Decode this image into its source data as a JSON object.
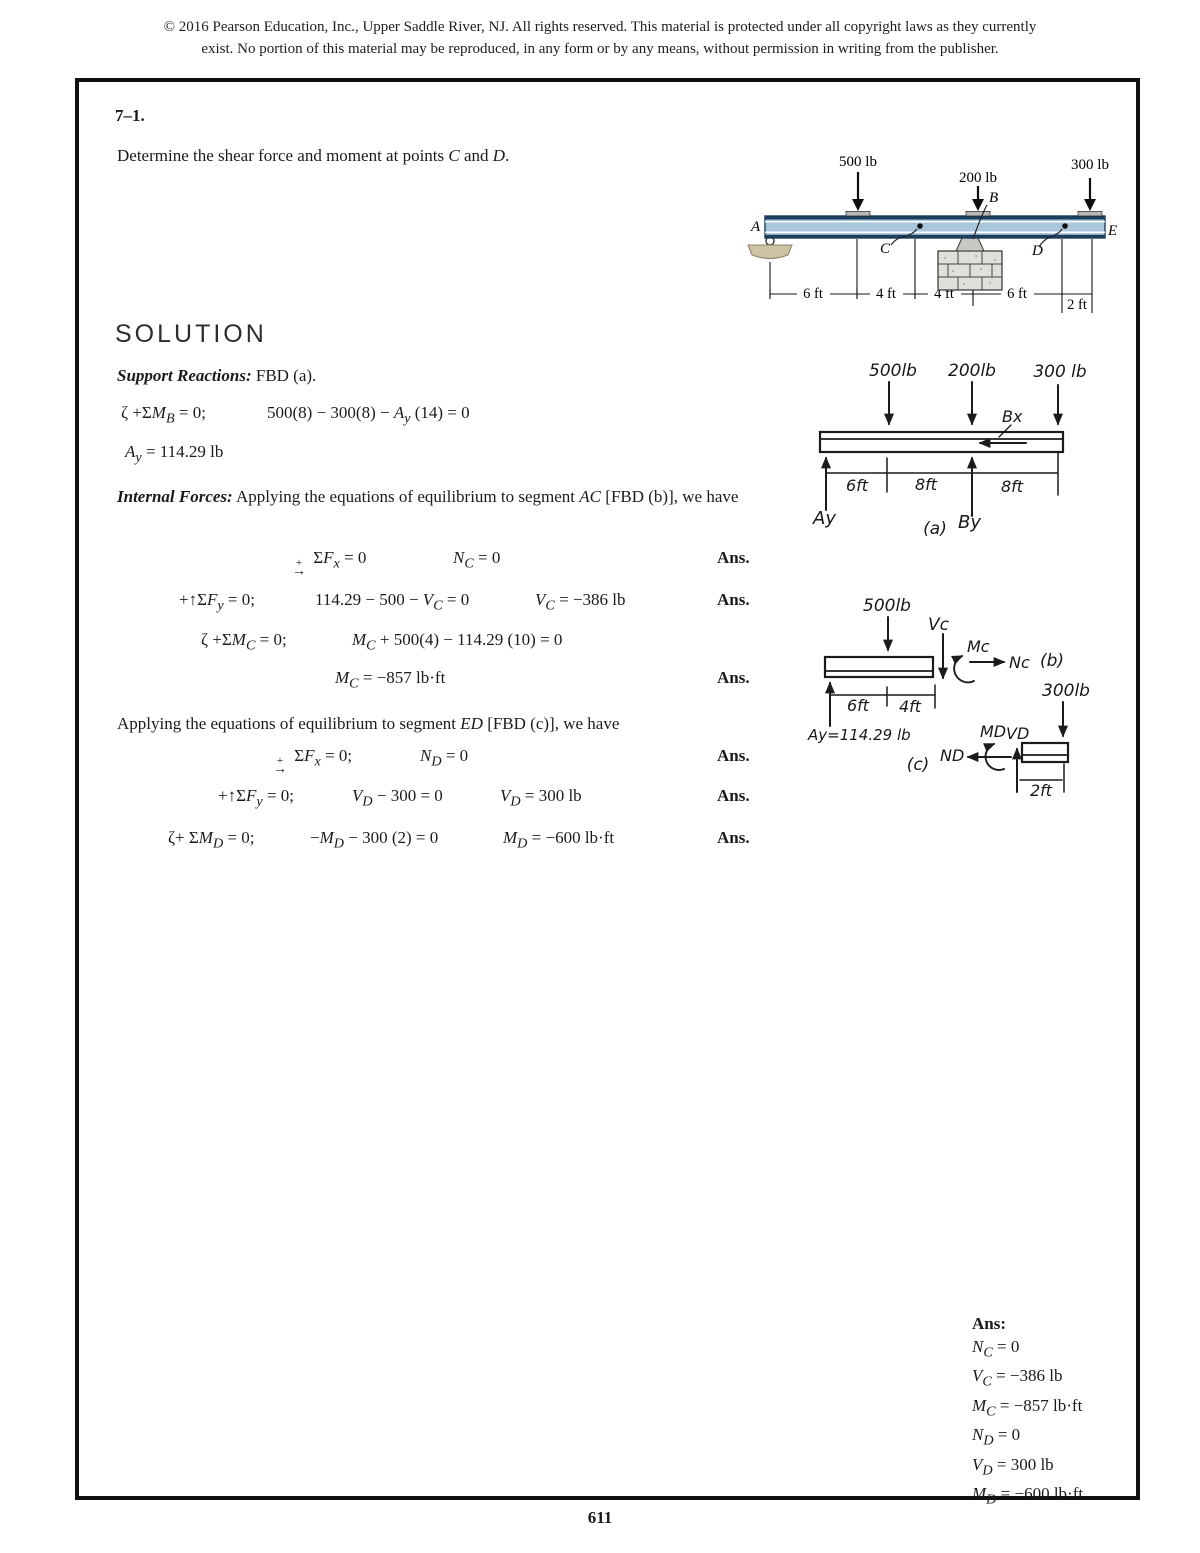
{
  "header": {
    "line1": "© 2016 Pearson Education, Inc., Upper Saddle River, NJ.  All rights reserved. This material is protected under all copyright laws as they currently",
    "line2": "exist. No portion of this material may be reproduced, in any form or by any means, without permission in writing from the publisher."
  },
  "problem": {
    "number": "7–1.",
    "statement": "Determine the shear force and moment at points <i>C</i> and <i>D</i>."
  },
  "figure": {
    "load1": "500 lb",
    "load2": "200 lb",
    "load3": "300 lb",
    "pt_a": "A",
    "pt_b": "B",
    "pt_c": "C",
    "pt_d": "D",
    "pt_e": "E",
    "dim1": "6 ft",
    "dim2": "4 ft",
    "dim3": "4 ft",
    "dim4": "6 ft",
    "dim5": "2 ft",
    "beam_fill": "#a9c7db",
    "beam_edge": "#1d3d5c"
  },
  "solution": {
    "heading": "SOLUTION",
    "support_label": "Support Reactions:",
    "support_text": " FBD (a).",
    "eq_mb_lhs": "ζ +Σ<i>M<sub>B</sub></i> = 0;",
    "eq_mb_rhs": "500(8) − 300(8) − <i>A<sub>y</sub></i> (14) = 0",
    "eq_ay": "<i>A<sub>y</sub></i> = 114.29 lb",
    "internal_label": "Internal Forces:",
    "internal_text": " Applying the equations of equilibrium to segment <i>AC</i> [FBD (b)], we have",
    "applying_ed": "Applying the equations of equilibrium to segment <i>ED</i> [FBD (c)], we have",
    "ans": "Ans.",
    "ac_rows": [
      {
        "lhs": "<span class='fx'><span>+</span><span>→</span></span> Σ<i>F<sub>x</sub></i> = 0",
        "mid": "<i>N<sub>C</sub></i> = 0"
      },
      {
        "lhs": "+↑Σ<i>F<sub>y</sub></i> = 0;",
        "mid": "114.29 − 500 − <i>V<sub>C</sub></i> = 0",
        "res": "<i>V<sub>C</sub></i> = −386 lb"
      },
      {
        "lhs": "ζ +Σ<i>M<sub>C</sub></i> = 0;",
        "mid": "<i>M<sub>C</sub></i> + 500(4) − 114.29 (10) = 0"
      },
      {
        "mid": "<i>M<sub>C</sub></i> = −857 lb·ft"
      }
    ],
    "ed_rows": [
      {
        "lhs": "<span class='fx'><span>+</span><span>→</span></span> Σ<i>F<sub>x</sub></i> = 0;",
        "mid": "<i>N<sub>D</sub></i> = 0"
      },
      {
        "lhs": "+↑Σ<i>F<sub>y</sub></i> = 0;",
        "mid": "<i>V<sub>D</sub></i> − 300 = 0",
        "res": "<i>V<sub>D</sub></i> = 300 lb"
      },
      {
        "lhs": "ζ+ Σ<i>M<sub>D</sub></i> = 0;",
        "mid": "−<i>M<sub>D</sub></i> − 300 (2) = 0",
        "res": "<i>M<sub>D</sub></i> = −600 lb·ft"
      }
    ]
  },
  "fbd_a": {
    "f1": "500lb",
    "f2": "200lb",
    "f3": "300 lb",
    "bx": "Bx",
    "ay": "Ay",
    "by": "By",
    "d1": "6ft",
    "d2": "8ft",
    "d3": "8ft",
    "tag": "(a)"
  },
  "fbd_b": {
    "f1": "500lb",
    "vc": "Vc",
    "mc": "Mc",
    "nc": "Nc",
    "ay": "Ay=114.29 lb",
    "d1": "6ft",
    "d2": "4ft",
    "tag": "(b)"
  },
  "fbd_c": {
    "f1": "300lb",
    "md": "MD",
    "vd": "VD",
    "nd": "ND",
    "d1": "2ft",
    "tag": "(c)"
  },
  "ans_block": {
    "heading": "Ans:",
    "lines": [
      "<i>N<sub>C</sub></i> = 0",
      "<i>V<sub>C</sub></i> = −386 lb",
      "<i>M<sub>C</sub></i> = −857 lb·ft",
      "<i>N<sub>D</sub></i> = 0",
      "<i>V<sub>D</sub></i> = 300 lb",
      "<i>M<sub>D</sub></i> = −600 lb·ft"
    ]
  },
  "page_number": "611"
}
